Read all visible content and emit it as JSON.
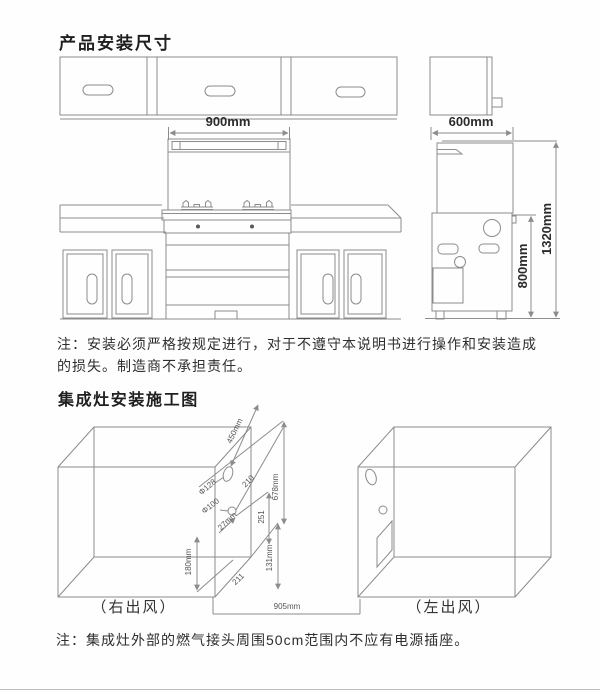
{
  "page": {
    "heading_product": "产品安装尺寸",
    "heading_construction": "集成灶安装施工图",
    "note_install": "注：安装必须严格按规定进行，对于不遵守本说明书进行操作和安装造成的损失。制造商不承担责任。",
    "note_socket": "注：集成灶外部的燃气接头周围50cm范围内不应有电源插座。"
  },
  "installation_drawing": {
    "stove_width": "900mm",
    "cabinet_depth": "600mm",
    "total_height": "1320mm",
    "counter_height": "800mm"
  },
  "construction_drawing": {
    "flue_center_offset": "450mm",
    "flue_hole_dia": "Φ128",
    "dim_210": "210",
    "panel_height": "678mm",
    "gas_hole_dia": "Φ100",
    "dim_27": "27mm",
    "dim_251": "251",
    "dim_180": "180mm",
    "dim_131": "131mm",
    "dim_211": "211",
    "opening_width": "905mm",
    "right_outlet": "（右出风）",
    "left_outlet": "（左出风）"
  },
  "colors": {
    "line": "#8c8c8c",
    "text": "#2b2b2b"
  }
}
